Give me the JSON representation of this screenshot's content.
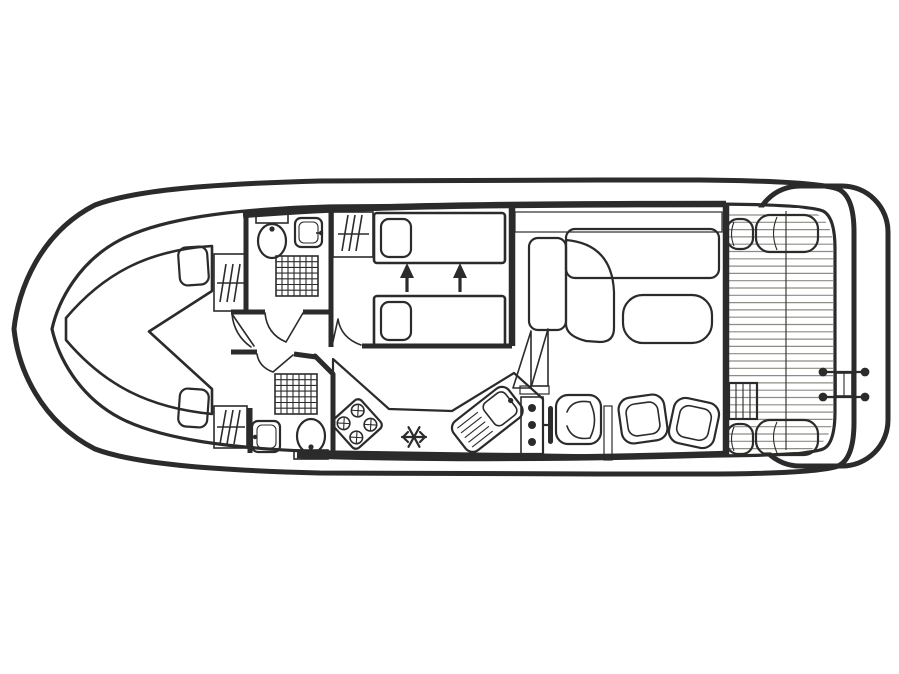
{
  "diagram": {
    "type": "boat-floor-plan",
    "name": "canal-cruiser-deck-layout",
    "orientation": "bow-left-stern-right"
  },
  "colors": {
    "outline": "#2b2b2b",
    "hull_white": "#ffffff",
    "floor": "#ebe8d3",
    "furniture_gray": "#d6d3c4",
    "counter_gray": "#d2cfbe",
    "bed_orange": "#ec9b4a",
    "pillow_orange": "#f3b478",
    "sofa_teal": "#8fccbd",
    "chair_pink": "#e5c8d4",
    "table_gray": "#d6d2c1",
    "step_cream": "#e9e6d1",
    "plank_line": "#8d8d85"
  },
  "rooms": [
    {
      "name": "bow-cabin",
      "fixtures": [
        "v-berth-double-bed",
        "pillow-port",
        "pillow-starboard",
        "wardrobe-port",
        "wardrobe-starboard"
      ]
    },
    {
      "name": "bathroom-forward",
      "fixtures": [
        "toilet",
        "washbasin",
        "shower"
      ]
    },
    {
      "name": "twin-cabin",
      "fixtures": [
        "single-bed-port",
        "single-bed-starboard",
        "pillows",
        "wardrobe",
        "beds-slide-together-arrows"
      ]
    },
    {
      "name": "bathroom-mid",
      "fixtures": [
        "toilet",
        "washbasin",
        "shower"
      ]
    },
    {
      "name": "galley",
      "fixtures": [
        "worktop",
        "hob-4-burner",
        "fridge-freezer-snowflake",
        "sink-with-drainer"
      ]
    },
    {
      "name": "saloon",
      "fixtures": [
        "sideboard",
        "l-shaped-sofa",
        "table"
      ]
    },
    {
      "name": "helm-dinette",
      "fixtures": [
        "helm-console",
        "instrument-dots",
        "steering-wheel",
        "helm-seat",
        "chair",
        "chair",
        "companionway-steps"
      ]
    },
    {
      "name": "aft-deck",
      "fixtures": [
        "planked-floor",
        "deck-divider",
        "corner-cushions",
        "boarding-steps",
        "stern-ladder"
      ]
    },
    {
      "name": "swim-platform",
      "fixtures": []
    }
  ]
}
